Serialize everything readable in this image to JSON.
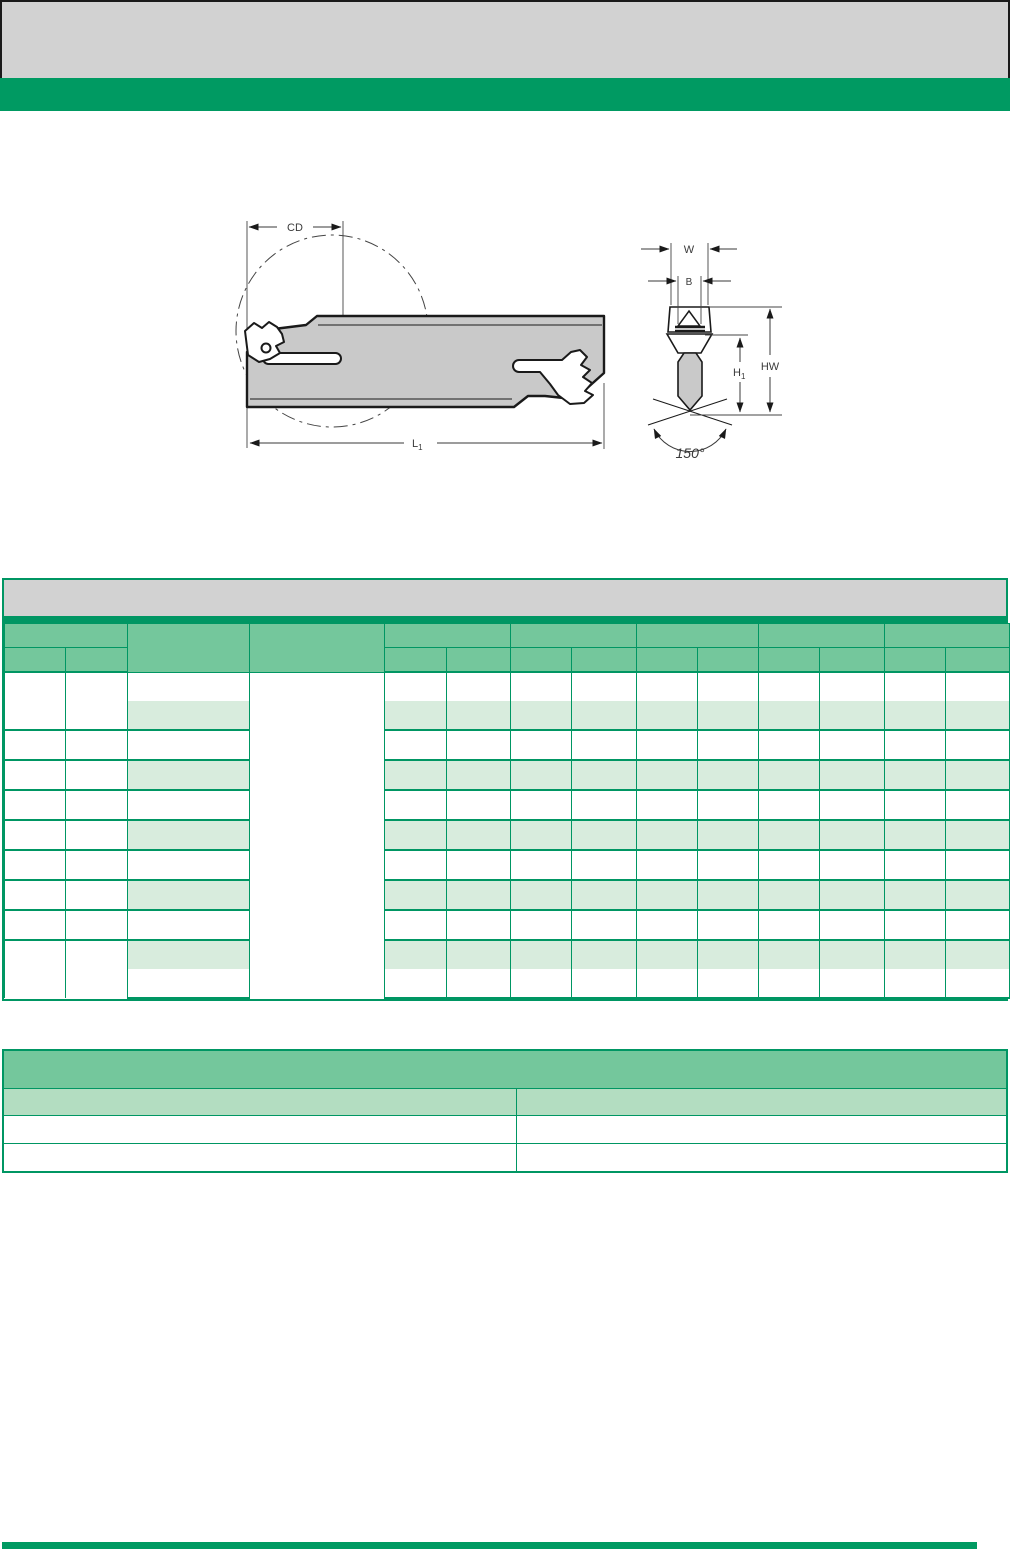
{
  "page": {
    "background": "#ffffff"
  },
  "top_banner": {
    "gray_band_color": "#d2d2d2",
    "green_stripe_color": "#009a62",
    "border_color": "#1a1a1a",
    "text": ""
  },
  "diagram": {
    "side_view": {
      "dim_cutting_diameter": "CD",
      "dim_length_base": "L",
      "dim_length_sub": "1"
    },
    "section_view": {
      "dim_blade_width": "W",
      "dim_insert_width": "B",
      "dim_h1_base": "H",
      "dim_h1_sub": "1",
      "dim_hw": "HW",
      "angle": "150°"
    },
    "blade_fill_color": "#c9c9c9",
    "line_color": "#1a1a1a"
  },
  "main_table": {
    "title": "",
    "title_band_color": "#d2d2d2",
    "header_color": "#74c79c",
    "row_stripe_color": "#d8ecdd",
    "border_color": "#009663",
    "column_count": 14,
    "column_widths_px": [
      61,
      62,
      122,
      135,
      62,
      64,
      61,
      65,
      61,
      61,
      61,
      65,
      61,
      64
    ],
    "body_row_count": 11,
    "header": {
      "row1_labels": [
        "",
        "",
        "",
        "",
        "",
        "",
        "",
        ""
      ],
      "row2_labels": [
        "",
        "",
        "",
        "",
        "",
        "",
        "",
        "",
        "",
        "",
        "",
        ""
      ]
    },
    "cells_text": ""
  },
  "secondary_table": {
    "title": "",
    "title_color": "#74c79c",
    "header_color": "#b3ddc1",
    "border_color": "#009663",
    "column_headers": [
      "",
      ""
    ],
    "rows": [
      [
        "",
        ""
      ],
      [
        "",
        ""
      ]
    ]
  },
  "footer": {
    "bar_color": "#009a62"
  }
}
